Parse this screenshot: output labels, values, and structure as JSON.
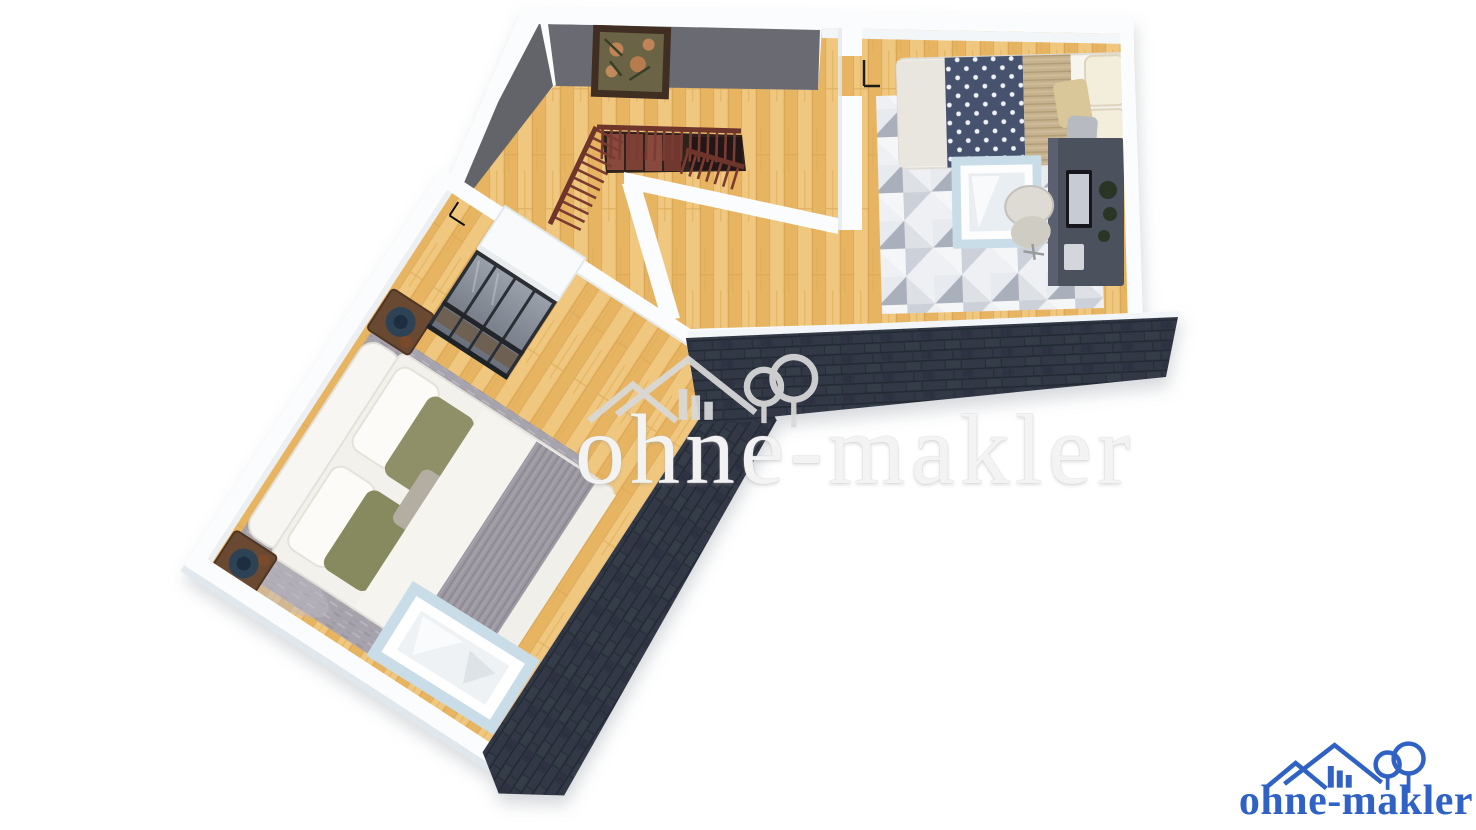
{
  "watermark": {
    "text": "ohne-makler",
    "icon": "house-with-trees-logo"
  },
  "brand_logo": {
    "text": "ohne-makler",
    "icon": "house-with-trees-logo",
    "color": "#2f62c4"
  },
  "palette": {
    "background": "#ffffff",
    "wood_base": "#ecbd6e",
    "wood_dark": "#e7b462",
    "wood_light": "#f0c77e",
    "wall_white": "#fbfcfd",
    "wall_shade": "#e9edf1",
    "wall_outer": "#dfe8ee",
    "accent_wall": "#6b6b72",
    "accent_wall_dark": "#63636a",
    "roof_dark": "#313845",
    "roof_line": "#242b35",
    "railing": "#7b3b31",
    "stair_tread": "#8a4a3e",
    "stair_void": "#2e211c",
    "rug_left": "#a7a3ac",
    "rug_right_light": "#eef0f3",
    "rug_right_dark": "#aab0bb",
    "duvet_navy": "#46536e",
    "duvet_beige": "#c6b28e",
    "blanket_gray": "#9c99a2",
    "pillow_olive": "#8f9067",
    "closet_frame": "#2b2f35",
    "desk_gray": "#4b515d",
    "skylight_frame": "#c9dde9",
    "watermark_gray": "#d9d9d9",
    "brand_blue": "#2f62c4"
  },
  "scene": {
    "type": "3D bird's-eye floor plan rendering of an attic storey",
    "rooms": [
      {
        "name": "landing",
        "features": [
          "staircase opening with dark red wood railing",
          "framed botanical picture on dark gray accent wall",
          "glass-front wardrobe",
          "door to left bedroom",
          "door to right bedroom"
        ]
      },
      {
        "name": "bedroom-right",
        "features": [
          "double bed with navy dotted and beige bedding",
          "geometric triangle rug",
          "dark desk with monitor",
          "office chair",
          "roof window frame"
        ]
      },
      {
        "name": "bedroom-left",
        "features": [
          "large double bed with olive pillows and gray knit blanket",
          "two dark nightstands with blue lamps",
          "gray area rug",
          "roof window frame"
        ]
      }
    ],
    "roof": "dark shingled roof sections along the lower outer edges"
  }
}
